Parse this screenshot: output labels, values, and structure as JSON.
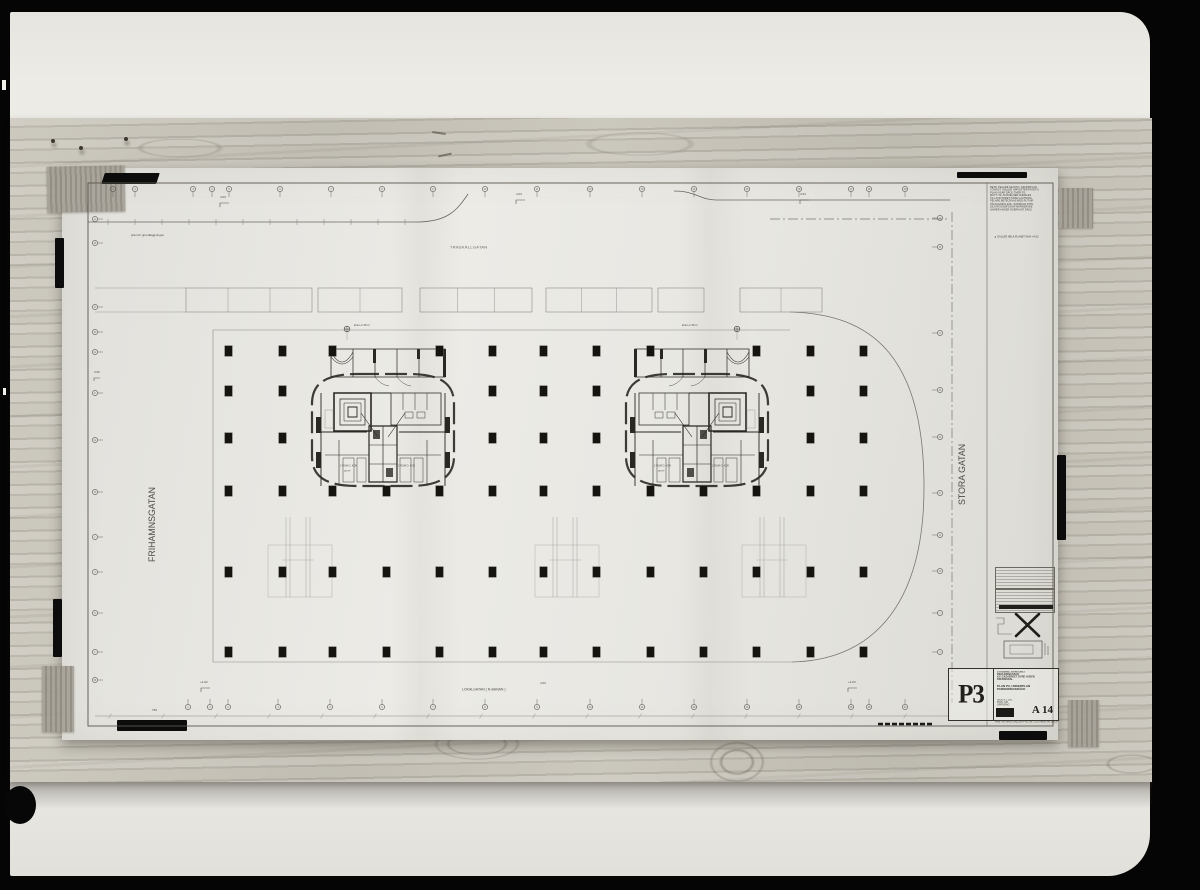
{
  "colors": {
    "paper": "#e7e6e1",
    "ink": "#2a2823",
    "faint_line": "#8a877e",
    "wood": "#c3bfb4",
    "tape_gray": "#9b968b",
    "tape_black": "#0c0c0c",
    "photo_frame": "#050505"
  },
  "title_block": {
    "sheet_number": "P3",
    "drawing_number": "A 14",
    "office_lines": [
      "STADSING. KONTORET  REGLERINGSAVD.",
      "KV. GASVERKET  ÖVRE  HUSEN",
      "BRUNNSDAL"
    ],
    "subject_lines": [
      "PLAN  P3,  UNDERPLAN",
      "PARKERINGSDÄCK"
    ],
    "meta_lines": [
      "SKALA  1:100",
      "RITN. NR",
      "UPPDRAG"
    ],
    "footer_line": "ARB. RITNING  GÄLLER  FR.O.M.  GJUTNING  AV  DÄCK"
  },
  "notes": {
    "lines": [
      "BETR. PELARE  SE  RITN.  GRUNDPLAN",
      "I ÖVRIGT  GÄLLER  UPPGIFTER  PÅ  RITN.",
      "PLAN  VISAR  DÄCK  ÖVER  P3",
      "MÅTT  I  M.  AVVIKELSER  ANMÄLES",
      "TILL  KONTORET  FÖRE  GJUTNING",
      "PELARE  BETECKNAS  MED  RUT-NR",
      "HÅLTAGNING  ENL.  SÄRSKILD  RITN.",
      "DILATATIONSFOGAR  MARKERADE",
      "NIVÅER  ANGER  ÖVERKANT  DÄCK"
    ],
    "footer": "GÄLLER  HELA  PLANET   NIVÅ  +4.03"
  },
  "streets": {
    "top": "TRÄSKÄLLGATAN",
    "bottom": "LOKALGATAN   ( N-BANAN )",
    "left": "FRIHAMNSGATAN",
    "right": "STORA GATAN"
  },
  "annotations": {
    "foundation_note": "plan för grundläggningen",
    "crane_note": "kran ⌀ 35 m",
    "spot_top_left": "4.03",
    "spot_top_mid": "4.03",
    "spot_top_right": "4.03",
    "spot_bottom_left": "+4.03",
    "spot_bottom_mid": "4.03",
    "spot_bottom_right": "+4.03",
    "spot_left_edge": "4.05",
    "dim_bottom_left": "750",
    "core_room_label": "2 RUM O. KÖK",
    "core_room_sub": "58 M²"
  },
  "plan": {
    "grid": {
      "col_x": [
        228,
        282,
        332,
        386,
        439,
        492,
        543,
        596,
        650,
        703,
        756,
        810,
        863
      ],
      "col_w": 7,
      "col_h": 10,
      "rows": [
        {
          "y": 351,
          "cols": [
            0,
            1,
            2,
            4,
            5,
            6,
            7,
            8,
            10,
            11,
            12
          ]
        },
        {
          "y": 391,
          "cols": [
            0,
            1,
            5,
            6,
            7,
            11,
            12
          ]
        },
        {
          "y": 438,
          "cols": [
            0,
            1,
            5,
            6,
            7,
            11,
            12
          ]
        },
        {
          "y": 491
        },
        {
          "y": 572
        },
        {
          "y": 652
        }
      ]
    },
    "axis_bubbles": {
      "top": {
        "y": 189,
        "x": [
          113,
          135,
          193,
          212,
          229,
          280,
          331,
          382,
          433,
          485,
          537,
          590,
          642,
          694,
          747,
          799,
          851,
          869,
          905
        ]
      },
      "bottom": {
        "y": 707,
        "x": [
          188,
          210,
          228,
          278,
          330,
          382,
          433,
          485,
          537,
          590,
          642,
          694,
          747,
          799,
          851,
          869,
          905
        ]
      },
      "left": {
        "x": 95,
        "y": [
          219,
          243,
          307,
          332,
          352,
          393,
          440,
          492,
          537,
          572,
          613,
          652,
          680
        ]
      },
      "right": {
        "x": 940,
        "y": [
          218,
          247,
          333,
          390,
          437,
          493,
          535,
          571,
          613,
          652
        ]
      }
    },
    "stall_band": {
      "y": 288,
      "h": 24,
      "groups": [
        {
          "x": 186,
          "w": 126,
          "cells": 3
        },
        {
          "x": 318,
          "w": 84,
          "cells": 2
        },
        {
          "x": 420,
          "w": 112,
          "cells": 3
        },
        {
          "x": 546,
          "w": 106,
          "cells": 3
        },
        {
          "x": 658,
          "w": 46,
          "cells": 1
        },
        {
          "x": 740,
          "w": 82,
          "cells": 2
        }
      ]
    },
    "ramps": [
      {
        "x": 278
      },
      {
        "x": 545
      },
      {
        "x": 752
      }
    ],
    "cores": [
      {
        "cx": 383,
        "mirrored": false
      },
      {
        "cx": 697,
        "mirrored": true
      }
    ]
  }
}
